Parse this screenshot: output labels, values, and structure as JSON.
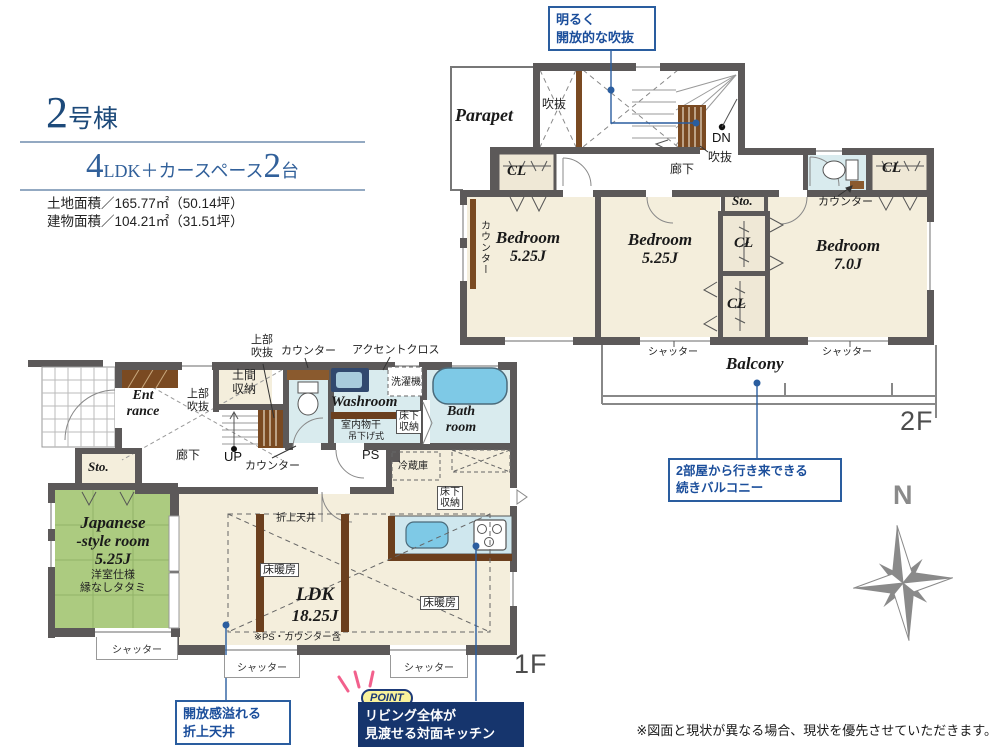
{
  "colors": {
    "accent_blue": "#2a5d9f",
    "navy_box": "#16356d",
    "title_blue": "#1d4a7a",
    "tatami_green": "#accb80",
    "wet_area_blue": "#d9ebee",
    "bathtub_blue": "#7ec9e6",
    "wood_brown": "#7a4a22",
    "wall_gray": "#5c5959",
    "room_cream": "#f4eedc",
    "point_yellow": "#f9f29b",
    "ray_pink": "#f2608c",
    "compass_gray": "#8a8a8a"
  },
  "header": {
    "building_number": "2",
    "building_suffix": "号棟",
    "layout_num1": "4",
    "layout_text1": "LDK＋カースペース",
    "layout_num2": "2",
    "layout_text2": "台",
    "land_area": "土地面積／165.77㎡（50.14坪）",
    "building_area": "建物面積／104.21㎡（31.51坪）"
  },
  "floor2": {
    "floor_label": "2F",
    "parapet": "Parapet",
    "void_label": "吹抜",
    "stair_void_label": "吹抜",
    "dn": "DN",
    "corridor": "廊下",
    "closet": "CL",
    "counter": "カウンター",
    "storage": "Sto.",
    "bedroom1": {
      "name": "Bedroom",
      "size": "5.25J"
    },
    "bedroom2": {
      "name": "Bedroom",
      "size": "5.25J"
    },
    "bedroom3": {
      "name": "Bedroom",
      "size": "7.0J"
    },
    "shutter": "シャッター",
    "balcony": "Balcony"
  },
  "floor1": {
    "floor_label": "1F",
    "upper_void_line1": "上部",
    "upper_void_line2": "吹抜",
    "counter": "カウンター",
    "accent_cloth": "アクセントクロス",
    "doma_line1": "土間",
    "doma_line2": "収納",
    "entrance_line1": "Ent",
    "entrance_line2": "rance",
    "washer": "洗濯機",
    "washroom": "Washroom",
    "drying_line1": "室内物干",
    "drying_line2": "吊下げ式",
    "underfloor_line1": "床下",
    "underfloor_line2": "収納",
    "bath_line1": "Bath",
    "bath_line2": "room",
    "storage": "Sto.",
    "corridor": "廊下",
    "up": "UP",
    "ps": "PS",
    "fridge": "冷蔵庫",
    "japanese_room": {
      "name1": "Japanese",
      "name2": "-style room",
      "size": "5.25J",
      "note1": "洋室仕様",
      "note2": "縁なしタタミ"
    },
    "raised_ceiling": "折上天井",
    "floor_heating": "床暖房",
    "ldk": {
      "name": "LDK",
      "size": "18.25J",
      "note": "※PS・カウンター含"
    },
    "shutter": "シャッター"
  },
  "callouts": {
    "void_note": {
      "line1": "明るく",
      "line2": "開放的な吹抜"
    },
    "balcony_note": {
      "line1": "2部屋から行き来できる",
      "line2": "続きバルコニー"
    },
    "ceiling_note": {
      "line1": "開放感溢れる",
      "line2": "折上天井"
    },
    "kitchen_note": {
      "line1": "リビング全体が",
      "line2": "見渡せる対面キッチン"
    },
    "point_badge": "POINT"
  },
  "compass": {
    "north": "N"
  },
  "disclaimer": "※図面と現状が異なる場合、現状を優先させていただきます。"
}
